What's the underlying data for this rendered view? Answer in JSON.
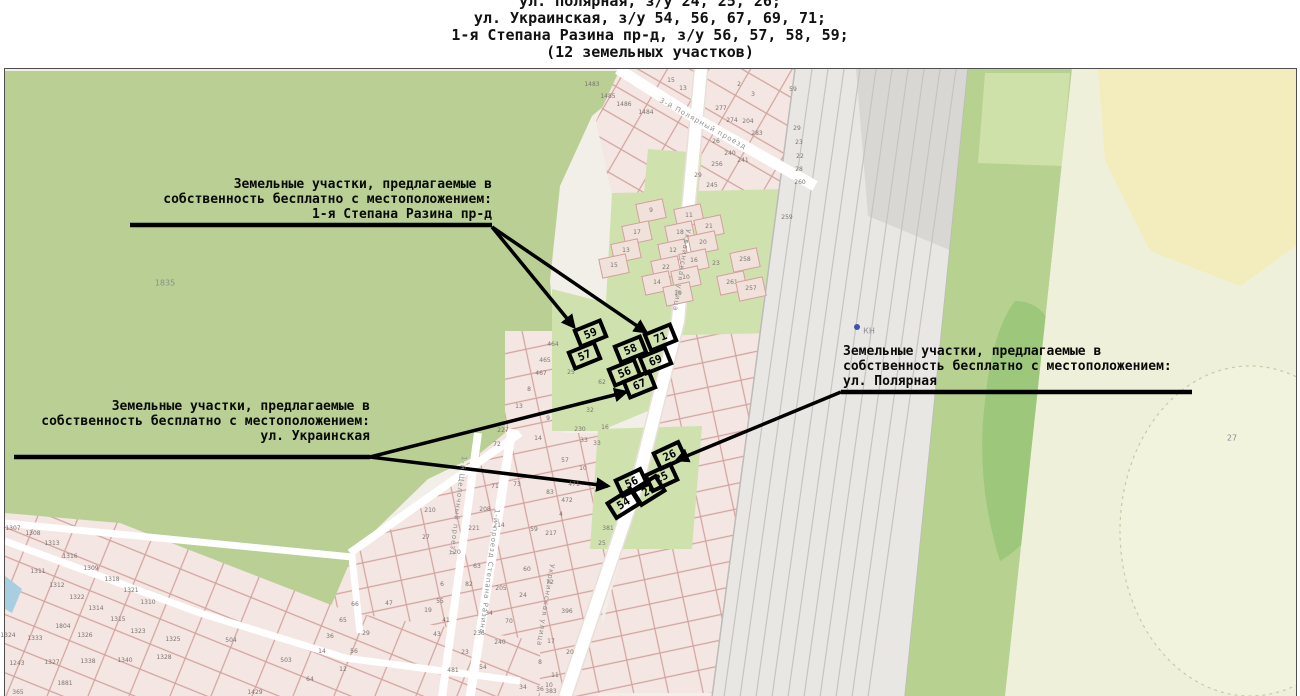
{
  "title": {
    "lines": [
      "ул. Полярная, з/у 24, 25, 26;",
      "ул. Украинская, з/у 54, 56, 67, 69, 71;",
      "1-я Степана Разина пр-д, з/у 56, 57, 58, 59;",
      "(12 земельных участков)"
    ]
  },
  "annotations": [
    {
      "id": "stepana-razina",
      "lines": [
        "Земельные участки, предлагаемые в",
        "собственность бесплатно с местоположением:",
        "1-я Степана Разина пр-д"
      ]
    },
    {
      "id": "ukrainskaya",
      "lines": [
        "Земельные участки, предлагаемые в",
        "собственность бесплатно с местоположением:",
        "ул. Украинская"
      ]
    },
    {
      "id": "polyarnaya",
      "lines": [
        "Земельные участки, предлагаемые в",
        "собственность бесплатно с местоположением:",
        "ул. Полярная"
      ]
    }
  ],
  "map": {
    "street_labels": [
      {
        "text": "Украинская улица",
        "x": 688,
        "y": 225,
        "rot": 99
      },
      {
        "text": "Украинская улица",
        "x": 552,
        "y": 560,
        "rot": 99
      },
      {
        "text": "3-й Полярный проезд",
        "x": 660,
        "y": 96,
        "rot": 29
      },
      {
        "text": "1-й проезд Степана Разина",
        "x": 497,
        "y": 505,
        "rot": 97
      },
      {
        "text": "1-й Щелочный проезд",
        "x": 464,
        "y": 452,
        "rot": 97
      }
    ],
    "area_labels": [
      {
        "text": "1835",
        "x": 165,
        "y": 283
      },
      {
        "text": "27",
        "x": 1232,
        "y": 438
      },
      {
        "text": "КН",
        "x": 869,
        "y": 331
      }
    ],
    "highlight_groups": [
      {
        "street": "1-я Степана Разина пр-д",
        "cells": [
          {
            "n": "59",
            "x": 590,
            "y": 333,
            "rot": -22
          },
          {
            "n": "57",
            "x": 584,
            "y": 355,
            "rot": -22
          },
          {
            "n": "58",
            "x": 630,
            "y": 349,
            "rot": -22
          },
          {
            "n": "56",
            "x": 624,
            "y": 372,
            "rot": -22
          }
        ]
      },
      {
        "street": "ул. Украинская",
        "cells": [
          {
            "n": "71",
            "x": 660,
            "y": 337,
            "rot": -22
          },
          {
            "n": "69",
            "x": 655,
            "y": 360,
            "rot": -22
          },
          {
            "n": "67",
            "x": 639,
            "y": 384,
            "rot": -22
          },
          {
            "n": "56",
            "x": 631,
            "y": 482,
            "rot": -25
          },
          {
            "n": "54",
            "x": 623,
            "y": 503,
            "rot": -32
          }
        ]
      },
      {
        "street": "ул. Полярная",
        "cells": [
          {
            "n": "26",
            "x": 669,
            "y": 455,
            "rot": -25
          },
          {
            "n": "25",
            "x": 661,
            "y": 477,
            "rot": -25
          },
          {
            "n": "24",
            "x": 648,
            "y": 490,
            "rot": -32
          }
        ]
      }
    ],
    "parcel_labels": [
      {
        "n": "1483",
        "x": 592,
        "y": 85
      },
      {
        "n": "1485",
        "x": 608,
        "y": 97
      },
      {
        "n": "1486",
        "x": 624,
        "y": 105
      },
      {
        "n": "1484",
        "x": 646,
        "y": 113
      },
      {
        "n": "15",
        "x": 671,
        "y": 81
      },
      {
        "n": "13",
        "x": 683,
        "y": 89
      },
      {
        "n": "2",
        "x": 739,
        "y": 85
      },
      {
        "n": "3",
        "x": 753,
        "y": 95
      },
      {
        "n": "59",
        "x": 793,
        "y": 90
      },
      {
        "n": "277",
        "x": 721,
        "y": 109
      },
      {
        "n": "274",
        "x": 732,
        "y": 121
      },
      {
        "n": "204",
        "x": 748,
        "y": 122
      },
      {
        "n": "283",
        "x": 757,
        "y": 134
      },
      {
        "n": "26",
        "x": 716,
        "y": 142
      },
      {
        "n": "240",
        "x": 730,
        "y": 154
      },
      {
        "n": "241",
        "x": 743,
        "y": 161
      },
      {
        "n": "256",
        "x": 717,
        "y": 165
      },
      {
        "n": "29",
        "x": 698,
        "y": 176
      },
      {
        "n": "245",
        "x": 712,
        "y": 186
      },
      {
        "n": "29",
        "x": 797,
        "y": 129
      },
      {
        "n": "23",
        "x": 799,
        "y": 143
      },
      {
        "n": "22",
        "x": 800,
        "y": 157
      },
      {
        "n": "28",
        "x": 799,
        "y": 170
      },
      {
        "n": "260",
        "x": 800,
        "y": 183
      },
      {
        "n": "259",
        "x": 787,
        "y": 218
      },
      {
        "n": "9",
        "x": 651,
        "y": 211,
        "b": 1
      },
      {
        "n": "17",
        "x": 637,
        "y": 233,
        "b": 1
      },
      {
        "n": "13",
        "x": 626,
        "y": 251,
        "b": 1
      },
      {
        "n": "15",
        "x": 614,
        "y": 266,
        "b": 1
      },
      {
        "n": "11",
        "x": 689,
        "y": 216,
        "b": 1
      },
      {
        "n": "21",
        "x": 709,
        "y": 227,
        "b": 1
      },
      {
        "n": "18",
        "x": 680,
        "y": 233,
        "b": 1
      },
      {
        "n": "20",
        "x": 703,
        "y": 243,
        "b": 1
      },
      {
        "n": "12",
        "x": 673,
        "y": 251,
        "b": 1
      },
      {
        "n": "16",
        "x": 694,
        "y": 261,
        "b": 1
      },
      {
        "n": "22",
        "x": 666,
        "y": 268,
        "b": 1
      },
      {
        "n": "10",
        "x": 686,
        "y": 278,
        "b": 1
      },
      {
        "n": "14",
        "x": 657,
        "y": 283,
        "b": 1
      },
      {
        "n": "19",
        "x": 678,
        "y": 294,
        "b": 1
      },
      {
        "n": "23",
        "x": 716,
        "y": 264
      },
      {
        "n": "258",
        "x": 745,
        "y": 260,
        "b": 1
      },
      {
        "n": "261",
        "x": 732,
        "y": 283,
        "b": 1
      },
      {
        "n": "257",
        "x": 751,
        "y": 289,
        "b": 1
      },
      {
        "n": "464",
        "x": 553,
        "y": 345
      },
      {
        "n": "465",
        "x": 545,
        "y": 361
      },
      {
        "n": "467",
        "x": 541,
        "y": 374
      },
      {
        "n": "8",
        "x": 529,
        "y": 390
      },
      {
        "n": "13",
        "x": 519,
        "y": 407
      },
      {
        "n": "9",
        "x": 548,
        "y": 419
      },
      {
        "n": "227",
        "x": 503,
        "y": 431
      },
      {
        "n": "14",
        "x": 538,
        "y": 439
      },
      {
        "n": "25",
        "x": 571,
        "y": 373
      },
      {
        "n": "62",
        "x": 602,
        "y": 383
      },
      {
        "n": "32",
        "x": 590,
        "y": 411
      },
      {
        "n": "16",
        "x": 605,
        "y": 428
      },
      {
        "n": "230",
        "x": 580,
        "y": 430
      },
      {
        "n": "33",
        "x": 584,
        "y": 441
      },
      {
        "n": "72",
        "x": 497,
        "y": 445
      },
      {
        "n": "33",
        "x": 597,
        "y": 444
      },
      {
        "n": "57",
        "x": 565,
        "y": 461
      },
      {
        "n": "10",
        "x": 583,
        "y": 469
      },
      {
        "n": "71",
        "x": 495,
        "y": 487
      },
      {
        "n": "73",
        "x": 517,
        "y": 485
      },
      {
        "n": "83",
        "x": 550,
        "y": 493
      },
      {
        "n": "471",
        "x": 574,
        "y": 485
      },
      {
        "n": "472",
        "x": 567,
        "y": 501
      },
      {
        "n": "4",
        "x": 561,
        "y": 515
      },
      {
        "n": "208",
        "x": 485,
        "y": 510
      },
      {
        "n": "210",
        "x": 430,
        "y": 511
      },
      {
        "n": "221",
        "x": 474,
        "y": 529
      },
      {
        "n": "214",
        "x": 499,
        "y": 526
      },
      {
        "n": "59",
        "x": 534,
        "y": 530
      },
      {
        "n": "217",
        "x": 551,
        "y": 534
      },
      {
        "n": "381",
        "x": 608,
        "y": 529
      },
      {
        "n": "25",
        "x": 602,
        "y": 544
      },
      {
        "n": "27",
        "x": 426,
        "y": 538
      },
      {
        "n": "20",
        "x": 457,
        "y": 553
      },
      {
        "n": "63",
        "x": 477,
        "y": 567
      },
      {
        "n": "6",
        "x": 442,
        "y": 585
      },
      {
        "n": "82",
        "x": 469,
        "y": 585
      },
      {
        "n": "60",
        "x": 527,
        "y": 570
      },
      {
        "n": "205",
        "x": 501,
        "y": 589
      },
      {
        "n": "24",
        "x": 523,
        "y": 596
      },
      {
        "n": "55",
        "x": 440,
        "y": 602
      },
      {
        "n": "19",
        "x": 428,
        "y": 611
      },
      {
        "n": "34",
        "x": 489,
        "y": 614
      },
      {
        "n": "70",
        "x": 509,
        "y": 622
      },
      {
        "n": "41",
        "x": 446,
        "y": 621
      },
      {
        "n": "43",
        "x": 437,
        "y": 635
      },
      {
        "n": "236",
        "x": 479,
        "y": 634
      },
      {
        "n": "240",
        "x": 500,
        "y": 643
      },
      {
        "n": "23",
        "x": 465,
        "y": 653
      },
      {
        "n": "17",
        "x": 551,
        "y": 642
      },
      {
        "n": "20",
        "x": 570,
        "y": 653
      },
      {
        "n": "8",
        "x": 540,
        "y": 663
      },
      {
        "n": "54",
        "x": 483,
        "y": 668
      },
      {
        "n": "481",
        "x": 453,
        "y": 671
      },
      {
        "n": "11",
        "x": 555,
        "y": 676
      },
      {
        "n": "72",
        "x": 550,
        "y": 583
      },
      {
        "n": "396",
        "x": 567,
        "y": 612
      },
      {
        "n": "10",
        "x": 549,
        "y": 686
      },
      {
        "n": "383",
        "x": 551,
        "y": 692
      },
      {
        "n": "34",
        "x": 523,
        "y": 688
      },
      {
        "n": "36",
        "x": 540,
        "y": 690
      },
      {
        "n": "504",
        "x": 231,
        "y": 641
      },
      {
        "n": "503",
        "x": 286,
        "y": 661
      },
      {
        "n": "64",
        "x": 310,
        "y": 680
      },
      {
        "n": "1429",
        "x": 255,
        "y": 693
      },
      {
        "n": "12",
        "x": 343,
        "y": 670
      },
      {
        "n": "14",
        "x": 322,
        "y": 652
      },
      {
        "n": "36",
        "x": 330,
        "y": 637
      },
      {
        "n": "65",
        "x": 343,
        "y": 621
      },
      {
        "n": "66",
        "x": 355,
        "y": 605
      },
      {
        "n": "29",
        "x": 366,
        "y": 634
      },
      {
        "n": "56",
        "x": 354,
        "y": 652
      },
      {
        "n": "47",
        "x": 389,
        "y": 604
      },
      {
        "n": "1307",
        "x": 13,
        "y": 529
      },
      {
        "n": "1308",
        "x": 33,
        "y": 534
      },
      {
        "n": "1313",
        "x": 52,
        "y": 544
      },
      {
        "n": "1316",
        "x": 70,
        "y": 557
      },
      {
        "n": "1309",
        "x": 91,
        "y": 569
      },
      {
        "n": "1311",
        "x": 38,
        "y": 572
      },
      {
        "n": "1318",
        "x": 112,
        "y": 580
      },
      {
        "n": "1312",
        "x": 57,
        "y": 586
      },
      {
        "n": "1321",
        "x": 131,
        "y": 591
      },
      {
        "n": "1322",
        "x": 77,
        "y": 598
      },
      {
        "n": "1310",
        "x": 148,
        "y": 603
      },
      {
        "n": "1314",
        "x": 96,
        "y": 609
      },
      {
        "n": "1315",
        "x": 118,
        "y": 620
      },
      {
        "n": "1804",
        "x": 63,
        "y": 627
      },
      {
        "n": "1323",
        "x": 138,
        "y": 632
      },
      {
        "n": "1324",
        "x": 8,
        "y": 636
      },
      {
        "n": "1333",
        "x": 35,
        "y": 639
      },
      {
        "n": "1326",
        "x": 85,
        "y": 636
      },
      {
        "n": "1325",
        "x": 173,
        "y": 640
      },
      {
        "n": "1243",
        "x": 17,
        "y": 664
      },
      {
        "n": "1327",
        "x": 52,
        "y": 663
      },
      {
        "n": "1338",
        "x": 88,
        "y": 662
      },
      {
        "n": "1340",
        "x": 125,
        "y": 661
      },
      {
        "n": "1328",
        "x": 164,
        "y": 658
      },
      {
        "n": "1881",
        "x": 65,
        "y": 684
      },
      {
        "n": "365",
        "x": 18,
        "y": 693
      }
    ]
  },
  "colors": {
    "map_green": "#b9cf93",
    "pale_green": "#cfe2ae",
    "parcel_fill": "#f4e6e2",
    "parcel_stroke": "#d2a39e",
    "railway_gray": "#e9e7e3",
    "right_band_green": "#b7d191",
    "right_pale": "#eef0da",
    "yellow_area": "#f3edbd",
    "water_blue": "#a8cfe0",
    "highlight_black": "#000000"
  }
}
